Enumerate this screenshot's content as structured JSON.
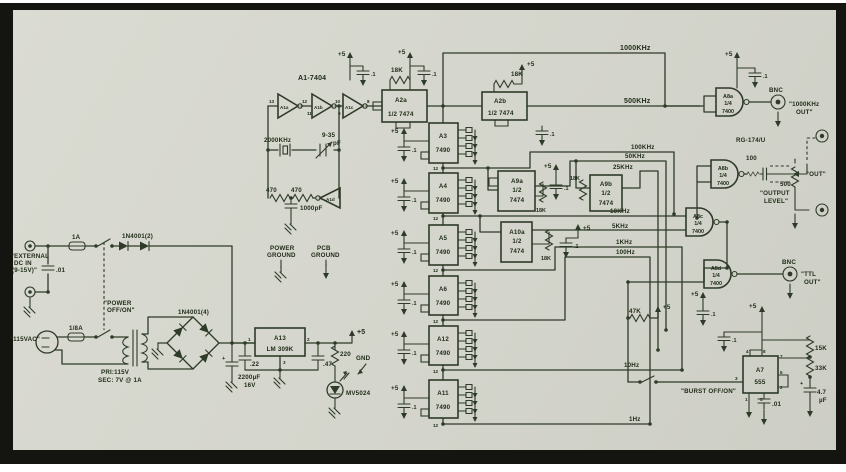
{
  "colors": {
    "ink": "#2e3b28",
    "paper": "#d4d5cc",
    "frame": "#141410"
  },
  "osc": {
    "ic": "A1-7404",
    "g1": "A1a",
    "g2": "A1b",
    "g3": "A1c",
    "g4": "A1d",
    "xtal": "2000KHz",
    "trim": "9-35",
    "trim_u": "pF",
    "r1": "470",
    "r2": "470",
    "c1": "1000pF",
    "p13": "13",
    "p12": "12",
    "p11": "11",
    "p10": "10",
    "p9": "9",
    "p8": "8"
  },
  "ff": {
    "a2a": "A2a",
    "a2b": "A2b",
    "half": "1/2 7474",
    "h1": "1/2",
    "h2": "7474",
    "a9a": "A9a",
    "a9b": "A9b",
    "a10a": "A10a",
    "r18k": "18K"
  },
  "ctr": {
    "a3": "A3",
    "a4": "A4",
    "a5": "A5",
    "a6": "A6",
    "a12": "A12",
    "a11": "A11",
    "part": "7490",
    "p12": "12"
  },
  "gate": {
    "a8a": "A8a",
    "a8b": "A8b",
    "a8c": "A8c",
    "a8d": "A8d",
    "q": "1/4",
    "part": "7400"
  },
  "rails": {
    "f1": "1000KHz",
    "f2": "500KHz",
    "f3": "100KHz",
    "f4": "50KHz",
    "f5": "25KHz",
    "f6": "10KHz",
    "f7": "5KHz",
    "f8": "1KHz",
    "f9": "100Hz",
    "f10": "10Hz",
    "f11": "1Hz"
  },
  "out": {
    "bnc": "BNC",
    "o1a": "\"1000KHz",
    "o1b": "OUT\"",
    "coax": "RG-174/U",
    "r100": "100",
    "pot": "500",
    "pl1": "\"OUTPUT",
    "pl2": "LEVEL\"",
    "out": "\"OUT\"",
    "t1": "\"TTL",
    "t2": "OUT\""
  },
  "burst": {
    "r1": "47K",
    "sw": "\"BURST OFF/ON\"",
    "a7": "A7",
    "part": "555",
    "r2": "15K",
    "r3": "33K",
    "c1": ".01",
    "c2a": "4.7",
    "c2b": "µF",
    "p4": "4",
    "p8": "8",
    "p7": "7",
    "p6": "6",
    "p2": "2",
    "p1": "1",
    "p5": "5",
    "p3": "3"
  },
  "pwr": {
    "e1": "\"EXTERNAL",
    "e2": "DC IN",
    "e3": "(9-15V)\"",
    "cin": ".01",
    "f1": "1A",
    "d2": "1N4001(2)",
    "s1": "\"POWER",
    "s2": "OFF/ON\"",
    "f2": "1/8A",
    "vac": "\"115VAC\"",
    "x1": "PRI:115V",
    "x2": "SEC: 7V @ 1A",
    "d4": "1N4001(4)",
    "cm1": "2200µF",
    "cm2": "16V",
    "a13": "A13",
    "reg": "LM 309K",
    "c22": ".22",
    "c47": ".47",
    "r220": "220",
    "led": "MV5024",
    "gnd": "GND",
    "p1": "1",
    "p2": "2",
    "p3": "3"
  },
  "legend": {
    "pg1": "POWER",
    "pg2": "GROUND",
    "pc1": "PCB",
    "pc2": "GROUND"
  },
  "misc": {
    "p5": "+5",
    "c01": ".1"
  }
}
